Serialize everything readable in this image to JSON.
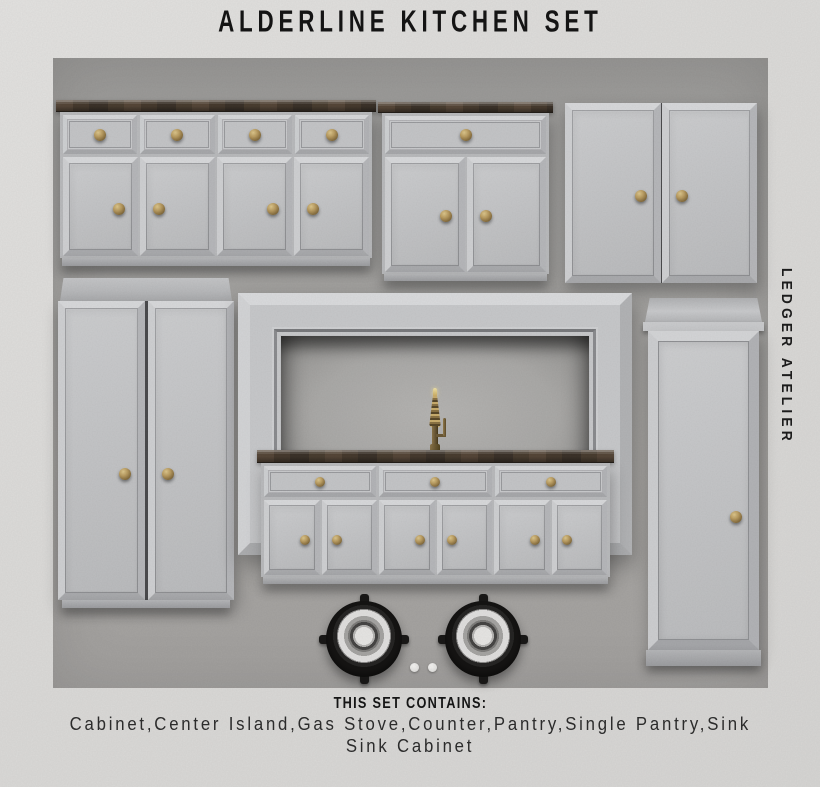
{
  "poster": {
    "title": "ALDERLINE KITCHEN SET",
    "brand": "LEDGER ATELIER",
    "footer": {
      "heading": "THIS SET CONTAINS:",
      "items_line1": "Cabinet,Center Island,Gas Stove,Counter,Pantry,Single Pantry,Sink",
      "items_line2": "Sink Cabinet"
    },
    "set_items": [
      "Cabinet",
      "Center Island",
      "Gas Stove",
      "Counter",
      "Pantry",
      "Single Pantry",
      "Sink",
      "Sink Cabinet"
    ],
    "colors": {
      "page_background": "#dcdbd9",
      "panel_background": "#a3a19f",
      "cabinet_body": "#c6c7c9",
      "cabinet_bevel_light": "#d8d9db",
      "cabinet_bevel_dark": "#a9aaad",
      "wood_countertop": "#43382d",
      "brass_knob": "#b79a60",
      "burner_black": "#161514",
      "burner_ring_white": "#e0dfde",
      "text_dark": "#151515"
    }
  }
}
